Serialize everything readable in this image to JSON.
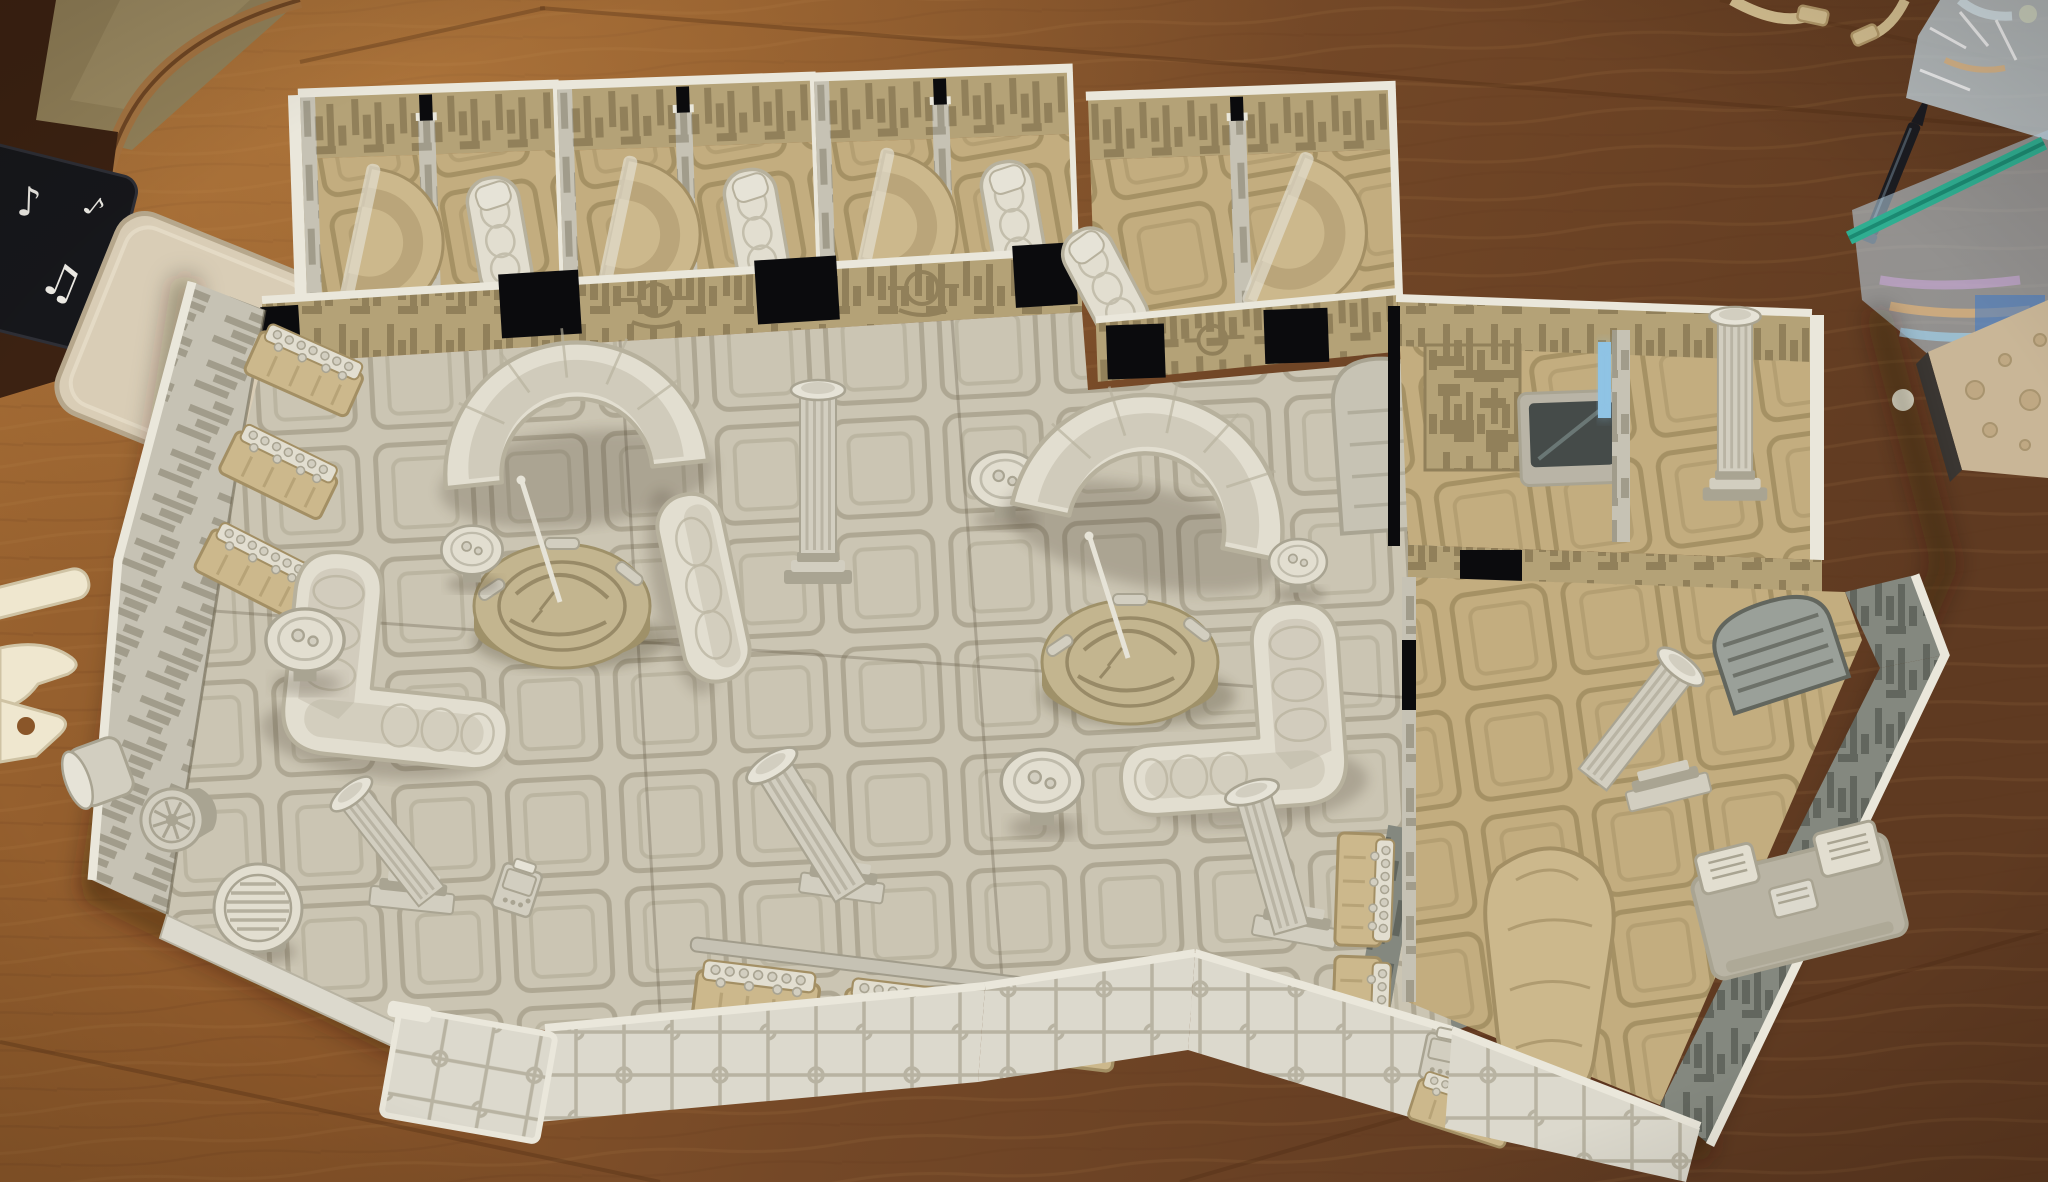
{
  "scene": {
    "kind": "photograph",
    "subject": "Modular 3D-printed sci-fi cantina tabletop terrain laid out on a wooden dining table"
  },
  "palette": {
    "wood1": "#a06832",
    "wood2": "#8a5629",
    "wood3": "#744827",
    "wood4": "#5f3a21",
    "wood-seam": "#4a2710",
    "grain-light": "#c89a5e",
    "grain-dark": "#5e3415",
    "olive-floor": "#93825a",
    "olive-floor2": "#a5946a",
    "dark-wood": "#3c2212",
    "edge-band": "#a87440",
    "coaster-black": "#16171b",
    "note-white": "#eceae4",
    "coaster-beige": "#d9cdb6",
    "coaster-beige-shade": "#b6a78c",
    "sprue": "#efe7cf",
    "sprue-shade": "#cfc3a4",
    "cable": "#d8c394",
    "cable-dark": "#b59b6b",
    "pen": "#1b1c21",
    "pen-hi": "#55626e",
    "bag-green": "#2fae91",
    "bag-green-dark": "#1b8a72",
    "irid1": "#9fd0ea",
    "irid2": "#c9a6d8",
    "irid3": "#e8b777",
    "irid-blue": "#3c78c8",
    "crater": "#c9b697",
    "crater-dot": "#a8946f",
    "crater-edge": "#3a3632",
    "trim": "#eae7db",
    "trim2": "#dcd9cd",
    "ext-line": "#b8b3a2",
    "wall-khaki": "#b4a277",
    "wall-khaki-dark": "#91805a",
    "wall-grey": "#c6c2b4",
    "wall-grey-dark": "#a19c8b",
    "wall-dark": "#84887f",
    "wall-dark-line": "#62665e",
    "floor-grey": "#cbc5b3",
    "floor-grey-line": "#a9a28d",
    "floor-tan": "#c3ad7f",
    "floor-tan-line": "#9e8a5e",
    "cream": "#e2ded0",
    "cream-shade": "#b7b19d",
    "tan": "#ccb88c",
    "tan-shade": "#a38f64",
    "table-body": "#c3b58f",
    "table-shade": "#9f9169",
    "table-eng": "#8d7f5c",
    "column": "#d2cec0",
    "column-shade": "#a9a492",
    "cap": "#e6e3d7",
    "black": "#0b0b0d",
    "screen": "#454b49",
    "screen-frame": "#b9b4a6",
    "blue-glow": "#8fc3e4"
  },
  "objects": {
    "table": {
      "label": "wooden dining table"
    },
    "floor_corner": {
      "label": "room floor visible past table corner"
    },
    "dark_sideboard": {
      "label": "dark wood furniture edge"
    },
    "coaster_music": {
      "label": "black coaster with white music notes",
      "notes": [
        "♪",
        "♫",
        "♩",
        "♫",
        "♪"
      ]
    },
    "coaster_beige": {
      "label": "square beige stone coaster"
    },
    "sprue_pieces": {
      "label": "white 3D-print scrap pieces"
    },
    "cables": {
      "label": "beige charging cables"
    },
    "pen": {
      "label": "black ballpoint pen"
    },
    "ziploc_bag": {
      "label": "zip-seal bag with iridescent contents"
    },
    "plastic_wrap": {
      "label": "crinkled iridescent plastic wrap"
    },
    "crater_board": {
      "label": "crater-textured print board"
    },
    "terrain": {
      "label": "modular 3D-printed cantina interior",
      "top_rooms": {
        "count": 8,
        "furniture": [
          "stepped round booth",
          "wall sofa"
        ]
      },
      "main_hall": {
        "furniture": [
          "bar bottle racks",
          "crescent booth",
          "holo table",
          "L-shaped sofa",
          "straight sofa",
          "side tables",
          "fluted columns",
          "vent table",
          "barrels",
          "cargo crates",
          "studded consoles",
          "loose wall slab"
        ]
      },
      "right_rooms": {
        "furniture": [
          "bed console with dark screen",
          "wall computer",
          "blue light door",
          "rounded door slab",
          "slatted saloon door",
          "desk console",
          "tan lounger booth",
          "fluted columns"
        ]
      }
    }
  }
}
